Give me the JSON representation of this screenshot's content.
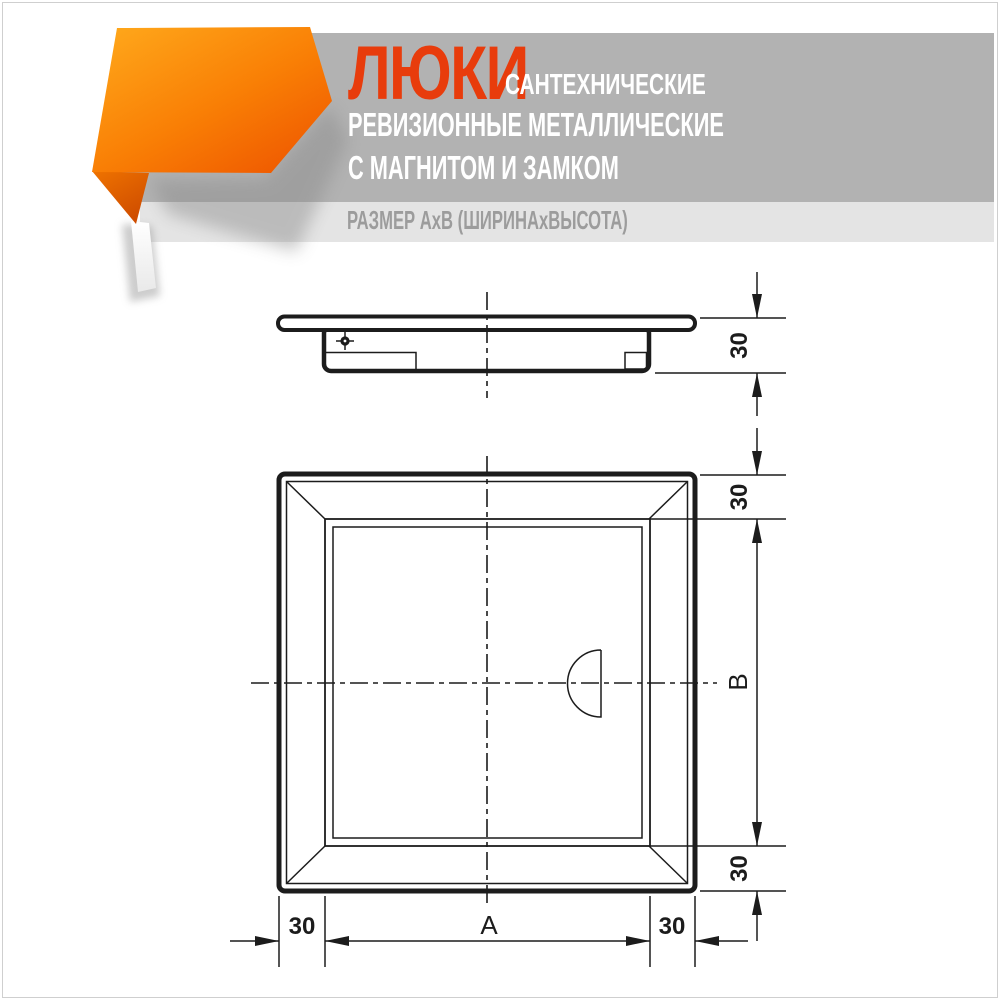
{
  "header": {
    "brand_word": "ЛЮКИ",
    "line1": "САНТЕХНИЧЕСКИЕ",
    "line2": "РЕВИЗИОННЫЕ МЕТАЛЛИЧЕСКИЕ",
    "line3": "С МАГНИТОМ И ЗАМКОМ",
    "subtitle": "РАЗМЕР АхВ (ШИРИНАхВЫСОТА)",
    "colors": {
      "accent": "#e83c0c",
      "title_band": "#b2b2b2",
      "subtitle_band": "#e4e4e4",
      "subtitle_text": "#9c9c9c",
      "ribbon_orange_light": "#ffaa1c",
      "ribbon_orange_dark": "#ee5600"
    }
  },
  "drawing": {
    "line_color": "#1c1c1c",
    "labels": {
      "side_depth": "30",
      "top_frame": "30",
      "bottom_frame": "30",
      "left_frame": "30",
      "right_frame": "30",
      "overall_width": "A",
      "overall_height": "B"
    }
  }
}
